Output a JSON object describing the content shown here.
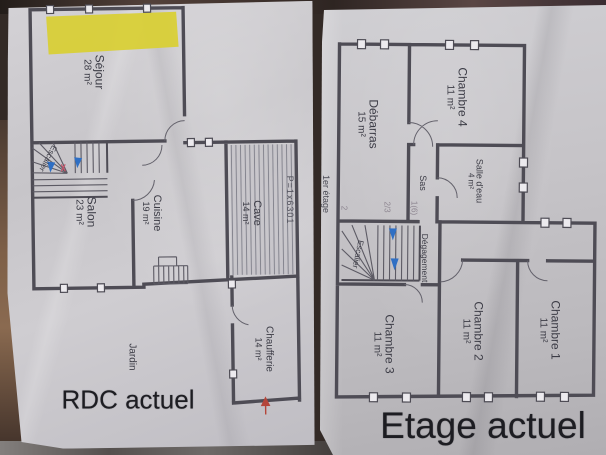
{
  "rdc": {
    "title": "RDC actuel",
    "rooms": [
      {
        "name": "Séjour",
        "area": "28 m²"
      },
      {
        "name": "Salon",
        "area": "23 m²"
      },
      {
        "name": "Cuisine",
        "area": "19 m²"
      },
      {
        "name": "Cave",
        "area": "14 m²"
      },
      {
        "name": "Chaufferie",
        "area": "14 m²"
      },
      {
        "name": "Jardin",
        "area": ""
      },
      {
        "name": "Escalier",
        "area": ""
      }
    ],
    "annotation": "P=1x6301"
  },
  "etage": {
    "title": "Etage actuel",
    "side_label": "1er étage",
    "rooms": [
      {
        "name": "Chambre 4",
        "area": "11 m²"
      },
      {
        "name": "Débarras",
        "area": "15 m²"
      },
      {
        "name": "Salle d'eau",
        "area": "4 m²"
      },
      {
        "name": "Sas",
        "area": ""
      },
      {
        "name": "Escalier",
        "area": ""
      },
      {
        "name": "Dégagement",
        "area": ""
      },
      {
        "name": "Chambre 3",
        "area": "11 m²"
      },
      {
        "name": "Chambre 2",
        "area": "11 m²"
      },
      {
        "name": "Chambre 1",
        "area": "11 m²"
      }
    ],
    "handwritten": [
      "2",
      "2/3",
      "1(6)"
    ]
  },
  "colors": {
    "highlight": "#d9cf38",
    "arrow_blue": "#2f6fc4",
    "arrow_red": "#b4453a",
    "wall": "#4e4c55",
    "paper": "#c7c5c9"
  }
}
